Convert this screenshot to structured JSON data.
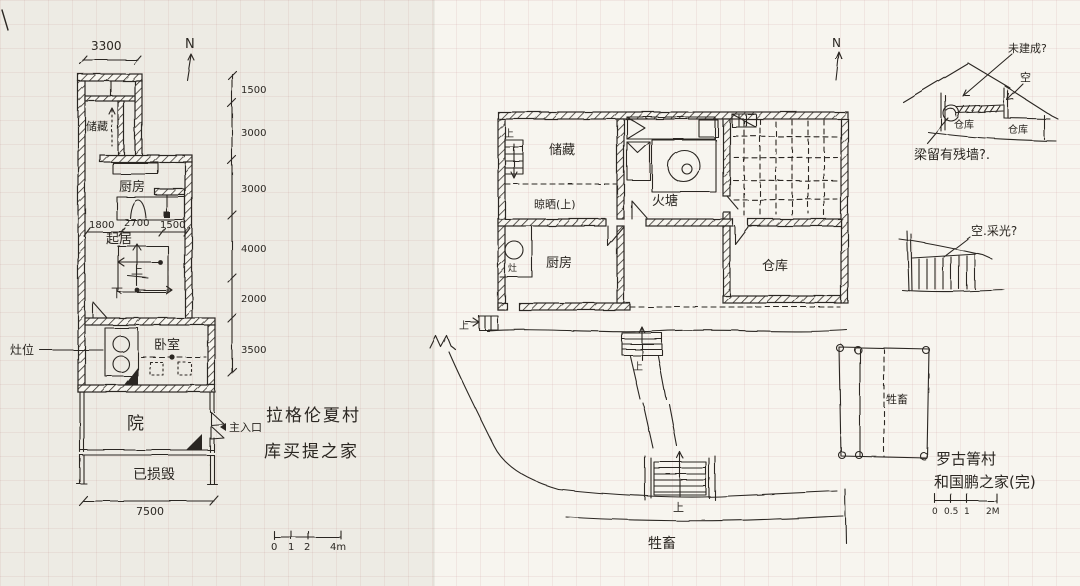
{
  "common": {
    "up": "上",
    "down": "下",
    "north": "N"
  },
  "left_plan": {
    "title_line1": "拉格伦夏村",
    "title_line2": "库买提之家",
    "dim_top": "3300",
    "dim_bottom": "7500",
    "dim_chain": [
      "1500",
      "3000",
      "3000",
      "4000",
      "2000",
      "3500"
    ],
    "dim_inner": [
      "1800",
      "2700",
      "1500"
    ],
    "rooms": {
      "storage": "储藏",
      "kitchen": "厨房",
      "living": "起居",
      "bedroom": "卧室",
      "courtyard": "院",
      "ruined": "已损毁"
    },
    "notes": {
      "stove": "灶位",
      "entrance": "主入口"
    },
    "scale_labels": [
      "0",
      "1",
      "2",
      "4m"
    ]
  },
  "right_plan": {
    "title_line1": "罗古箐村",
    "title_line2": "和国鹏之家(完)",
    "rooms": {
      "storage": "储藏",
      "drying": "晾晒(上)",
      "firepit": "火塘",
      "kitchen": "厨房",
      "stove": "灶",
      "warehouse": "仓库"
    },
    "notes": {
      "pen": "牲畜",
      "road": "牲畜"
    },
    "scale_labels": [
      "0",
      "0.5",
      "1",
      "2M"
    ]
  },
  "sections": {
    "roof_note": "未建成?",
    "void_note": "空",
    "left_room": "仓库",
    "right_room": "仓库",
    "beam_note": "梁留有残墙?.",
    "shed_note": "空.采光?"
  }
}
